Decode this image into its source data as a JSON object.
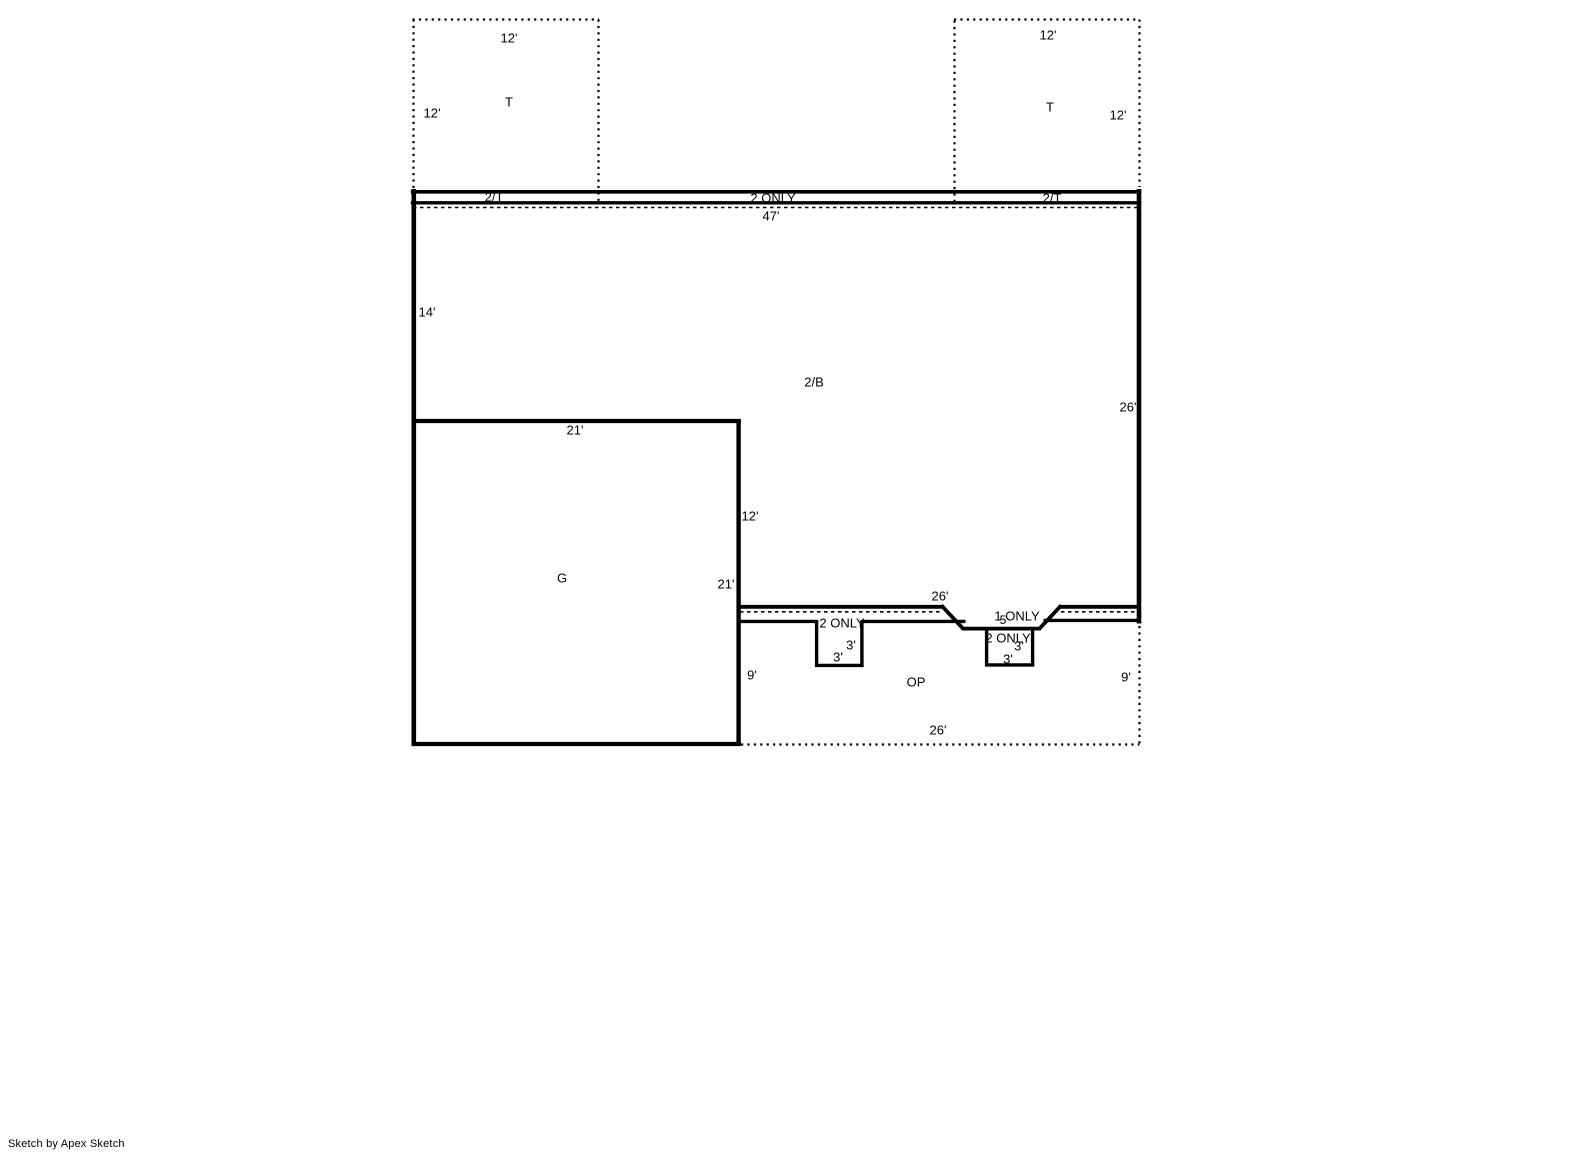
{
  "watermark": "Sketch by Apex Sketch",
  "colors": {
    "line": "#000000",
    "background": "#ffffff",
    "text": "#000000"
  },
  "labels": [
    {
      "name": "dim-12-top-left-box",
      "text": "12'",
      "x": 509,
      "y": 38
    },
    {
      "name": "area-t-left",
      "text": "T",
      "x": 509,
      "y": 102
    },
    {
      "name": "dim-12-left-box-side",
      "text": "12'",
      "x": 432,
      "y": 113
    },
    {
      "name": "dim-12-top-right-box",
      "text": "12'",
      "x": 1048,
      "y": 35
    },
    {
      "name": "area-t-right",
      "text": "T",
      "x": 1050,
      "y": 107
    },
    {
      "name": "dim-12-right-box-side",
      "text": "12'",
      "x": 1118,
      "y": 115
    },
    {
      "name": "area-2t-left",
      "text": "2/T",
      "x": 494,
      "y": 197
    },
    {
      "name": "area-2-only-strip",
      "text": "2 ONLY",
      "x": 773,
      "y": 198
    },
    {
      "name": "area-2t-right",
      "text": "2/T",
      "x": 1052,
      "y": 198
    },
    {
      "name": "dim-47",
      "text": "47'",
      "x": 771,
      "y": 216
    },
    {
      "name": "dim-14",
      "text": "14'",
      "x": 427,
      "y": 312
    },
    {
      "name": "area-2b",
      "text": "2/B",
      "x": 814,
      "y": 382
    },
    {
      "name": "dim-26-right",
      "text": "26'",
      "x": 1128,
      "y": 407
    },
    {
      "name": "dim-21-g-top",
      "text": "21'",
      "x": 575,
      "y": 430
    },
    {
      "name": "dim-12-g-right",
      "text": "12'",
      "x": 750,
      "y": 516
    },
    {
      "name": "area-g",
      "text": "G",
      "x": 562,
      "y": 578
    },
    {
      "name": "dim-21-g-right",
      "text": "21'",
      "x": 726,
      "y": 584
    },
    {
      "name": "dim-26-south-top",
      "text": "26'",
      "x": 940,
      "y": 596
    },
    {
      "name": "area-1-only",
      "text": "1 ONLY",
      "x": 1017,
      "y": 616
    },
    {
      "name": "dim-5",
      "text": "5",
      "x": 1003,
      "y": 620,
      "size": 12
    },
    {
      "name": "area-2-only-notch1",
      "text": "2 ONLY",
      "x": 842,
      "y": 623
    },
    {
      "name": "area-2-only-notch2",
      "text": "2 ONLY",
      "x": 1008,
      "y": 638
    },
    {
      "name": "dim-3-notch1-a",
      "text": "3'",
      "x": 851,
      "y": 645
    },
    {
      "name": "dim-3-notch1-b",
      "text": "3'",
      "x": 838,
      "y": 657
    },
    {
      "name": "dim-3-notch2-a",
      "text": "3'",
      "x": 1019,
      "y": 646
    },
    {
      "name": "dim-3-notch2-b",
      "text": "3'",
      "x": 1008,
      "y": 659
    },
    {
      "name": "dim-9-left",
      "text": "9'",
      "x": 752,
      "y": 675
    },
    {
      "name": "area-op",
      "text": "OP",
      "x": 916,
      "y": 682
    },
    {
      "name": "dim-9-right",
      "text": "9'",
      "x": 1126,
      "y": 677
    },
    {
      "name": "dim-26-op-bottom",
      "text": "26'",
      "x": 938,
      "y": 730
    }
  ]
}
